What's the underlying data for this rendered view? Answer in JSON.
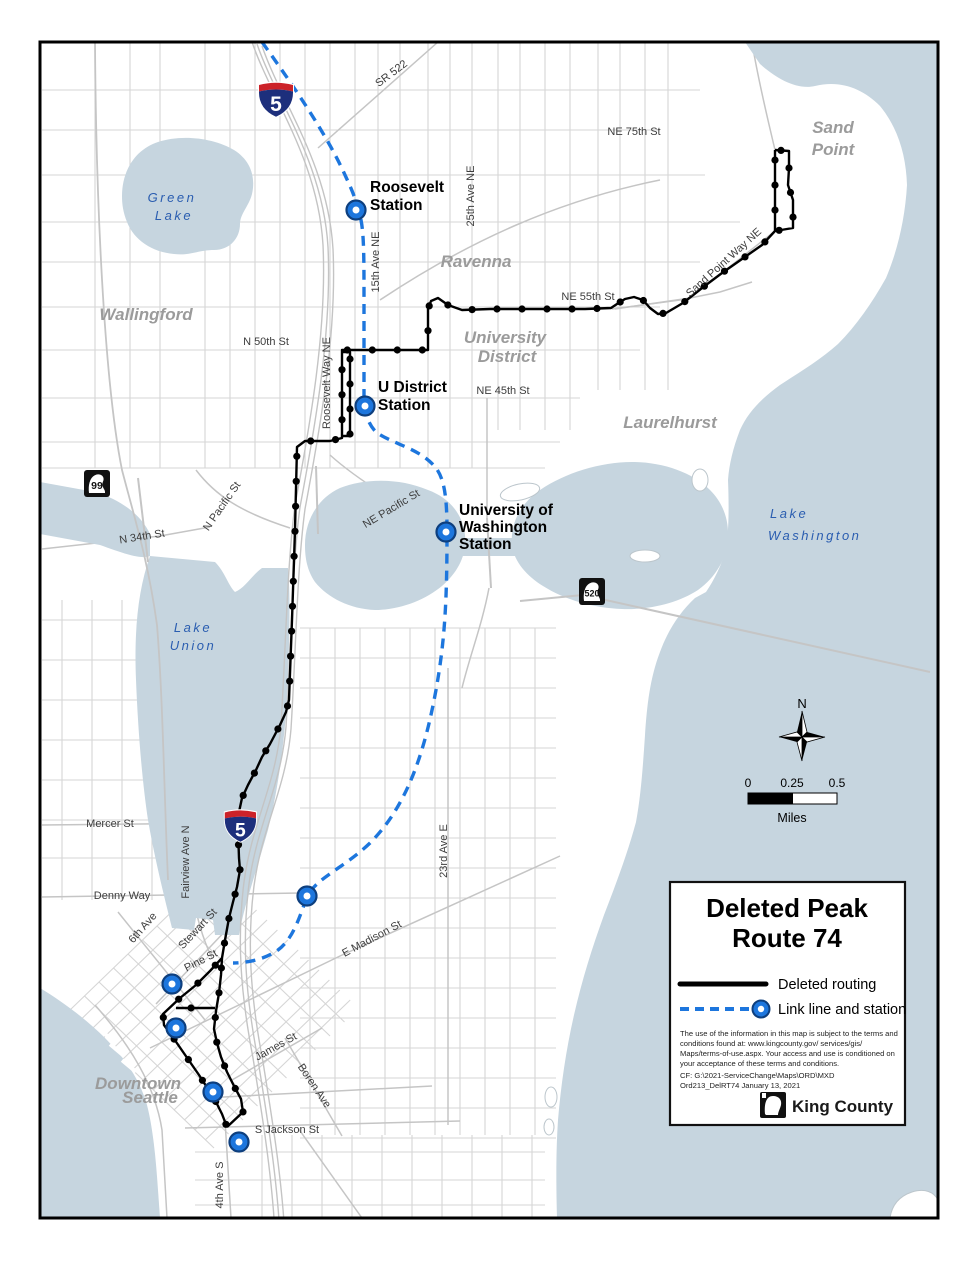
{
  "map": {
    "stations": {
      "roosevelt": {
        "lines": [
          "Roosevelt",
          "Station"
        ]
      },
      "u_district": {
        "lines": [
          "U District",
          "Station"
        ]
      },
      "uw": {
        "lines": [
          "University of",
          "Washington",
          "Station"
        ]
      }
    },
    "streets": {
      "sr522": "SR 522",
      "ne75": "NE 75th St",
      "ne55": "NE 55th St",
      "n50": "N 50th St",
      "ne45": "NE 45th St",
      "ave25": "25th Ave NE",
      "ave15": "15th Ave NE",
      "roosevelt_way": "Roosevelt Way NE",
      "sandpoint_way": "Sand Point Way NE",
      "ne_pacific": "NE Pacific St",
      "n_pacific": "N Pacific St",
      "n34": "N 34th St",
      "mercer": "Mercer St",
      "fairview": "Fairview Ave N",
      "denny": "Denny Way",
      "ave6": "6th Ave",
      "stewart": "Stewart St",
      "pine": "Pine St",
      "e_madison": "E Madison St",
      "ave23": "23rd Ave E",
      "james": "James St",
      "boren": "Boren Ave",
      "s_jackson": "S Jackson St",
      "ave4": "4th Ave S"
    },
    "neighborhoods": {
      "sand_point": [
        "Sand",
        "Point"
      ],
      "wallingford": "Wallingford",
      "ravenna": "Ravenna",
      "university_district": [
        "University",
        "District"
      ],
      "laurelhurst": "Laurelhurst",
      "downtown_seattle": [
        "Downtown",
        "Seattle"
      ]
    },
    "water_labels": {
      "green_lake": [
        "Green",
        "Lake"
      ],
      "lake_union": [
        "Lake",
        "Union"
      ],
      "lake_washington": [
        "Lake",
        "Washington"
      ]
    },
    "shields": {
      "i5": "5",
      "sr99": "99",
      "sr520": "520"
    },
    "compass_n": "N",
    "scale": {
      "t0": "0",
      "t1": "0.25",
      "t2": "0.5",
      "units": "Miles"
    }
  },
  "legend": {
    "title": [
      "Deleted Peak",
      "Route 74"
    ],
    "deleted_label": "Deleted routing",
    "link_label": "Link line and station",
    "disclaimer": [
      "The use of the information in this map is subject to the terms and",
      "conditions found at:  www.kingcounty.gov/ services/gis/",
      "Maps/terms-of-use.aspx.  Your access and use is conditioned on",
      "your acceptance of these terms and conditions."
    ],
    "file_ref": [
      "CF:  G:\\2021-ServiceChange\\Maps\\ORD\\MXD",
      "Ord213_DelRT74  January 13, 2021"
    ],
    "brand": "King County"
  },
  "colors": {
    "water": "#c6d5df",
    "route_black": "#000000",
    "link_blue": "#1d76dd",
    "street_gray": "#d2d2d2",
    "shield_blue": "#1d2f7c",
    "shield_red": "#cc2229"
  }
}
